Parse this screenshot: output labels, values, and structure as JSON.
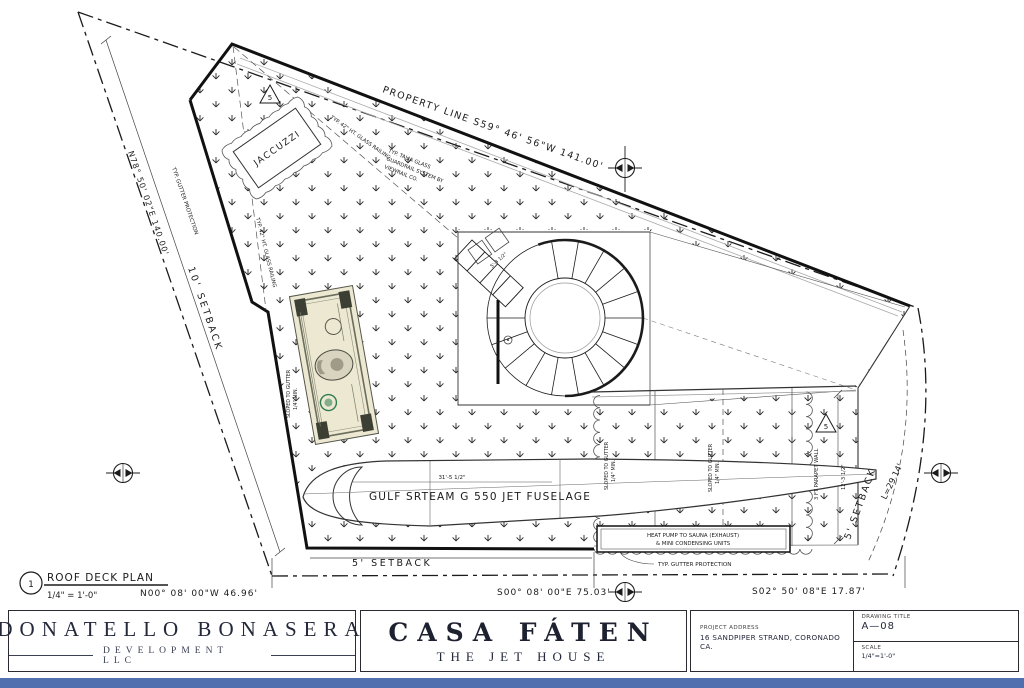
{
  "plan": {
    "view": {
      "number": "1",
      "title": "ROOF DECK PLAN",
      "scale": "1/4\" = 1'-0\""
    },
    "bearings": {
      "top": "PROPERTY LINE  S59° 46' 56\"W  141.00'",
      "left": "N78° 50' 02\"E  140.00'",
      "bottom_left": "N00° 08' 00\"W  46.96'",
      "bottom_center": "S00° 08' 00\"E  75.03'",
      "bottom_right": "S02° 50' 08\"E  17.87'",
      "right_curve": "L=29.14'"
    },
    "setbacks": {
      "left": "10' SETBACK",
      "bottom": "5' SETBACK",
      "right": "5' SETBACK"
    },
    "features": {
      "jacuzzi": "JACCUZZI",
      "fuselage": "GULF SRTEAM G 550 JET FUSELAGE",
      "keynote": "5"
    },
    "dimensions": {
      "fuselage_length": "31'-5 1/2\"",
      "stair_landing": "5'-3 1/2\"",
      "parapet": "12'-3 1/2\""
    },
    "notes": {
      "gutter_protection": "TYP. GUTTER PROTECTION",
      "glass_railing": "TYP. 42\" HT. GLASS RAILING",
      "guardrail_1": "TYP. TALIA GLASS",
      "guardrail_2": "GUARDRAIL SYSTEM BY",
      "guardrail_3": "VIEWRAIL CO.",
      "parapet_wall": "3 FT PARAPET WALL",
      "heat_pump_1": "HEAT PUMP TO SAUNA (EXHAUST)",
      "heat_pump_2": "& MINI CONDENSING UNITS",
      "sloped_1": "SLOPED TO GUTTER",
      "sloped_2": "1/4\" MIN."
    }
  },
  "title_block": {
    "developer": "DONATELLO BONASERA",
    "developer_sub": "DEVELOPMENT LLC",
    "project": "CASA FÁTEN",
    "project_sub": "THE JET HOUSE",
    "address_label": "PROJECT ADDRESS",
    "address": "16 SANDPIPER STRAND, CORONADO CA.",
    "drawing_title_label": "DRAWING TITLE",
    "drawing_number": "A—08",
    "scale_label": "SCALE",
    "scale_value": "1/4\"=1'-0\""
  },
  "decorations": {
    "dollar_bill": "one-dollar-bill-image",
    "survey_marker": "survey-marker-icon",
    "turf_pattern": "ground-cover-hatch"
  },
  "colors": {
    "line": "#1b1b1b",
    "gray": "#9a9a9a",
    "bottom_bar": "#4f6fae"
  }
}
